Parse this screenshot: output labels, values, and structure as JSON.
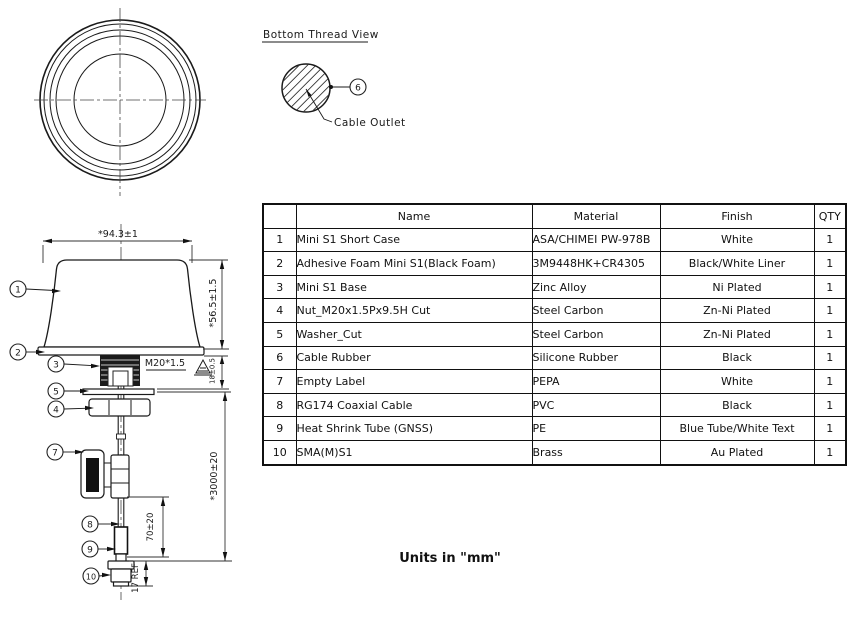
{
  "drawing": {
    "bottom_view": {
      "title": "Bottom Thread View",
      "cable_outlet": "Cable Outlet"
    },
    "balloons": {
      "b1": "1",
      "b2": "2",
      "b3": "3",
      "b4": "4",
      "b5": "5",
      "b6": "6",
      "b7": "7",
      "b8": "8",
      "b9": "9",
      "b10": "10"
    },
    "dims": {
      "width": "*94.3±1",
      "height": "*56.5±1.5",
      "thread_spec": "M20*1.5",
      "thread_height": "18±0.5",
      "cable_length": "*3000±20",
      "shrink_offset": "70±20",
      "connector_ref": "17 REF"
    }
  },
  "table": {
    "headers": {
      "no": "",
      "name": "Name",
      "material": "Material",
      "finish": "Finish",
      "qty": "QTY"
    },
    "rows": [
      {
        "no": "1",
        "name": "Mini S1 Short Case",
        "material": "ASA/CHIMEI PW-978B",
        "finish": "White",
        "qty": "1"
      },
      {
        "no": "2",
        "name": "Adhesive Foam Mini S1(Black Foam)",
        "material": "3M9448HK+CR4305",
        "finish": "Black/White Liner",
        "qty": "1"
      },
      {
        "no": "3",
        "name": "Mini S1 Base",
        "material": "Zinc Alloy",
        "finish": "Ni Plated",
        "qty": "1"
      },
      {
        "no": "4",
        "name": "Nut_M20x1.5Px9.5H Cut",
        "material": "Steel Carbon",
        "finish": "Zn-Ni Plated",
        "qty": "1"
      },
      {
        "no": "5",
        "name": "Washer_Cut",
        "material": "Steel Carbon",
        "finish": "Zn-Ni Plated",
        "qty": "1"
      },
      {
        "no": "6",
        "name": "Cable Rubber",
        "material": "Silicone Rubber",
        "finish": "Black",
        "qty": "1"
      },
      {
        "no": "7",
        "name": "Empty Label",
        "material": "PEPA",
        "finish": "White",
        "qty": "1"
      },
      {
        "no": "8",
        "name": "RG174 Coaxial Cable",
        "material": "PVC",
        "finish": "Black",
        "qty": "1"
      },
      {
        "no": "9",
        "name": "Heat Shrink Tube (GNSS)",
        "material": "PE",
        "finish": "Blue Tube/White Text",
        "qty": "1"
      },
      {
        "no": "10",
        "name": "SMA(M)S1",
        "material": "Brass",
        "finish": "Au Plated",
        "qty": "1"
      }
    ]
  },
  "footer": {
    "units": "Units in \"mm\""
  }
}
